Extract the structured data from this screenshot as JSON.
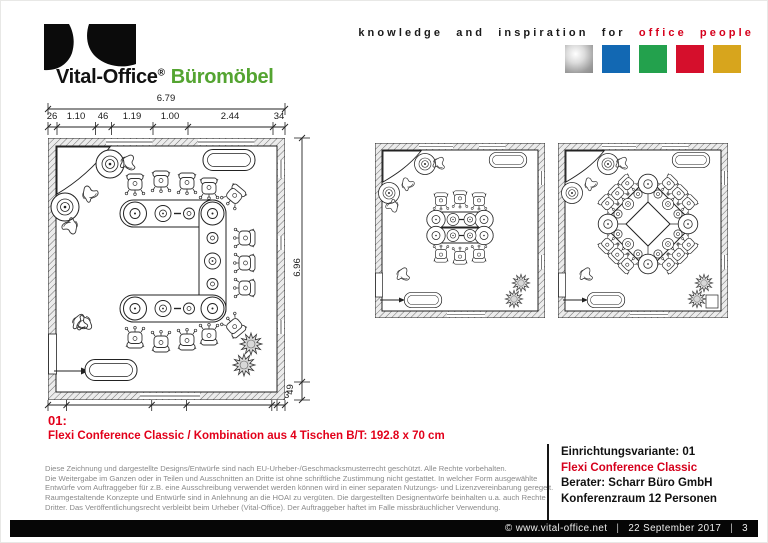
{
  "brand": {
    "name": "Vital-Office",
    "registered": "®",
    "product_line": "Büromöbel"
  },
  "tagline": {
    "prefix": "knowledge and inspiration for",
    "highlight": "office people"
  },
  "colors": {
    "brand_green": "#54a431",
    "accent_red": "#d6001c",
    "square_silver": "#b5b5b5",
    "square_blue": "#1268b3",
    "square_green": "#23a14d",
    "square_red": "#d50f2c",
    "square_gold": "#d7a51d"
  },
  "plan_dimensions": {
    "total_width": "6.79",
    "top_segments": [
      "26",
      "1.10",
      "46",
      "1.19",
      "1.00",
      "2.44",
      "34"
    ],
    "total_height": "6.96",
    "height_offset": "49",
    "bottom_segments": [
      "53",
      "2.44",
      "1.00",
      "2.44",
      "15",
      "23"
    ]
  },
  "variant": {
    "number": "01:",
    "description": "Flexi Conference Classic / Kombination aus 4 Tischen B/T: 192.8 x 70 cm"
  },
  "legal_lines": [
    "Diese Zeichnung und dargestellte Designs/Entwürfe sind nach EU-Urheber-/Geschmacksmusterrecht geschützt. Alle Rechte vorbehalten.",
    "Die Weitergabe im Ganzen oder in Teilen und Ausschnitten an Dritte ist ohne schriftliche Zustimmung nicht gestattet. In welcher Form ausgewählte",
    "Entwürfe vom Auftraggeber für z.B. eine Ausschreibung verwendet werden können wird in einer separaten Nutzungs- und Lizenzvereinbarung geregelt.",
    "Raumgestaltende Konzepte und Entwürfe sind in Anlehnung an die HOAI zu vergüten. Die dargestellten Designentwürfe beinhalten u.a. auch Rechte",
    "Dritter. Das Veröffentlichungsrecht verbleibt beim Urheber (Vital-Office). Der Auftraggeber haftet im Falle missbräuchlicher Verwendung."
  ],
  "info_panel": {
    "variant": "Einrichtungsvariante: 01",
    "product": "Flexi Conference Classic",
    "consultant": "Berater: Scharr Büro GmbH",
    "room": "Konferenzraum 12 Personen"
  },
  "footer": {
    "website": "© www.vital-office.net",
    "separator": "|",
    "date": "22 September 2017",
    "page": "3"
  }
}
